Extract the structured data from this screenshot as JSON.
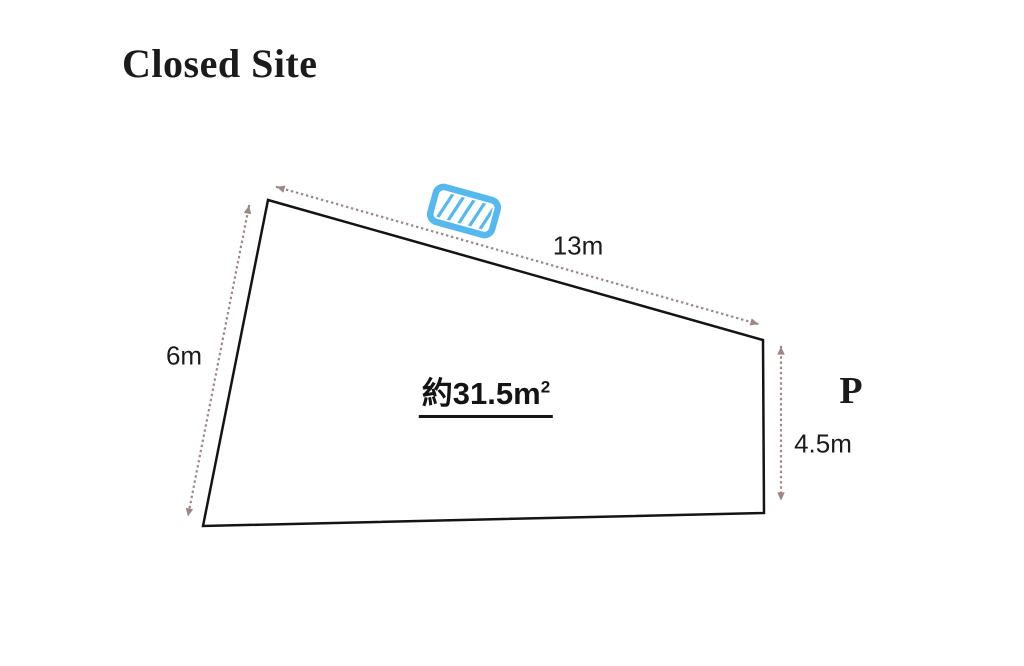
{
  "title": "Closed Site",
  "diagram": {
    "dim_top": "13m",
    "dim_left": "6m",
    "dim_right": "4.5m",
    "parking_label": "P",
    "area": {
      "prefix": "約",
      "value": "31.5",
      "unit_base": "m",
      "unit_exponent": "2"
    }
  },
  "colors": {
    "text": "#1b1b1b",
    "outline": "#141414",
    "dimension_arrow": "#9c8888",
    "marker_blue": "#55b8ef",
    "marker_fill": "#ffffff"
  },
  "icons": {
    "marker": "hatched-rectangle-marker-icon"
  }
}
